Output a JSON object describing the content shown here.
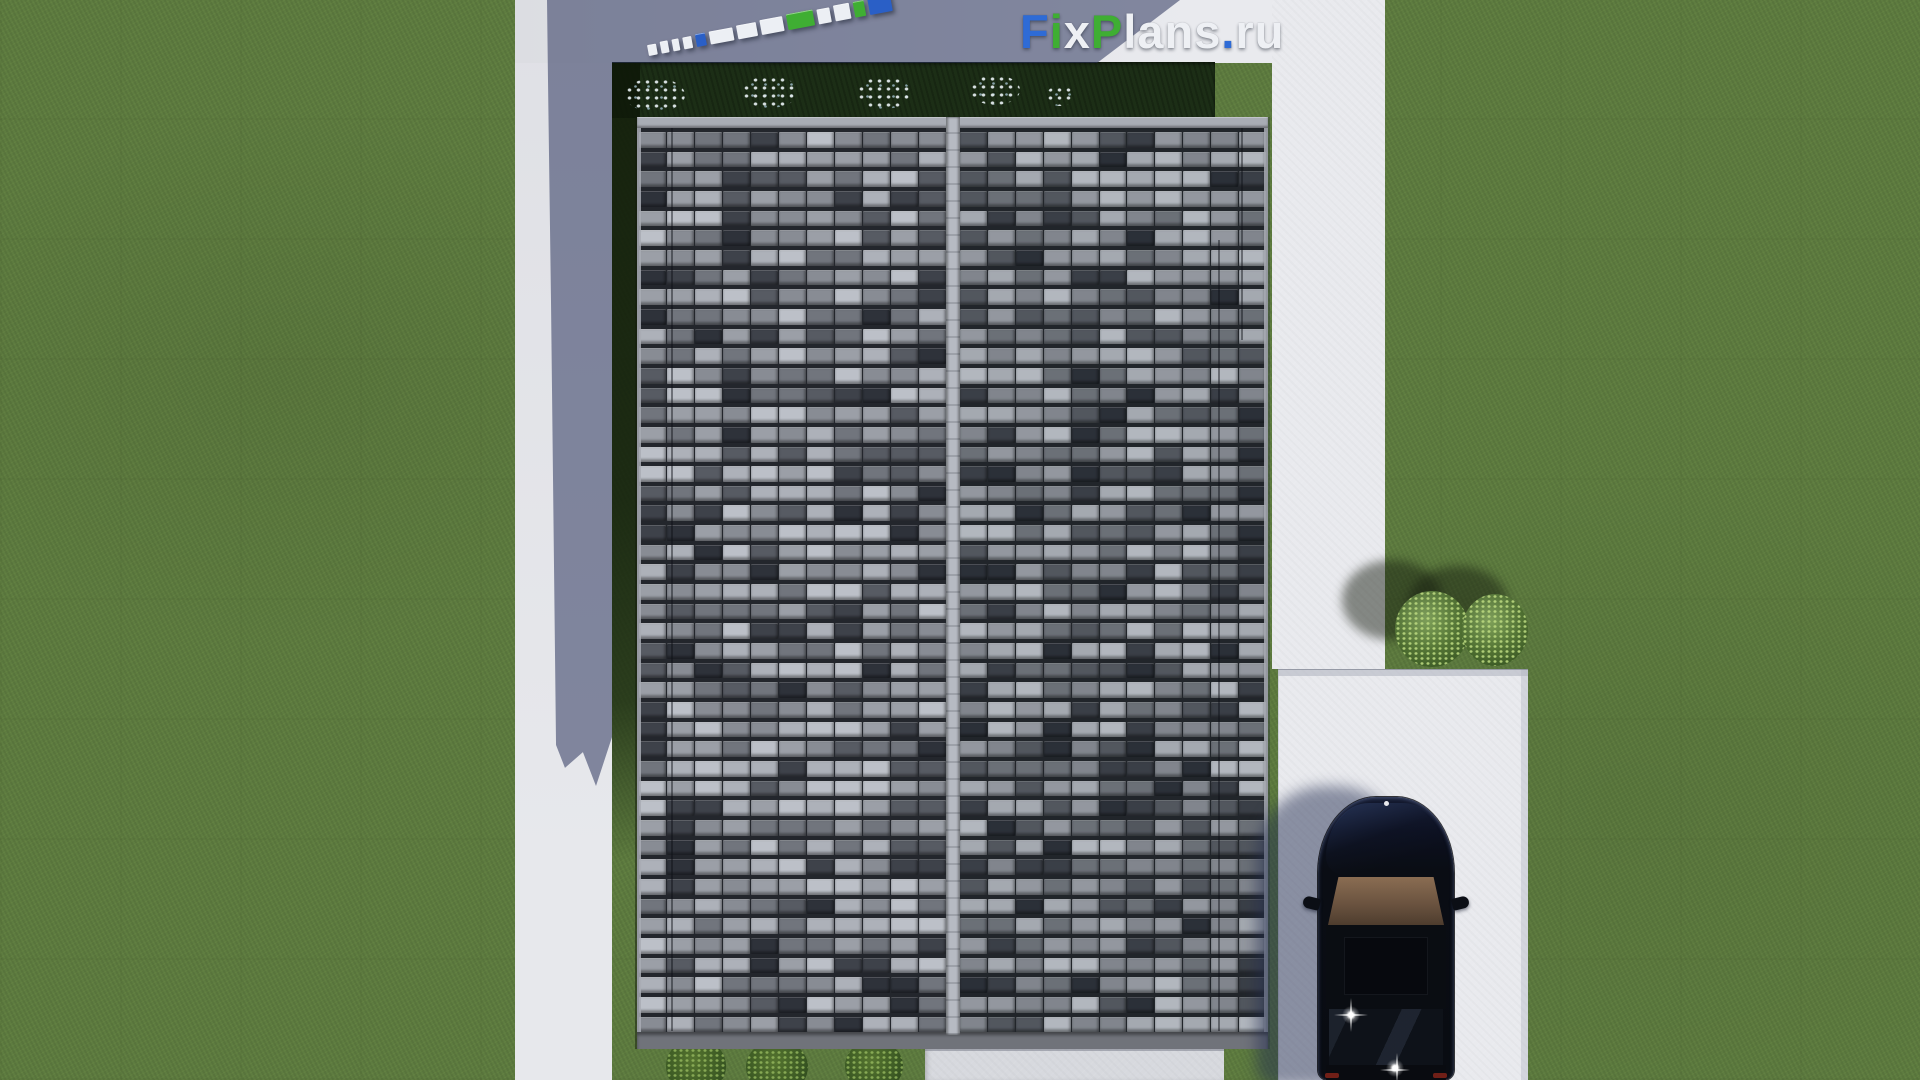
{
  "meta": {
    "width_px": 1920,
    "height_px": 1080,
    "description": "Aerial top-down 3D render of a gabled tiled house roof with lawn, concrete walkways, driveway, parked dark car, bushes and FixPlans.ru watermark"
  },
  "watermark": {
    "text": "FixPlans.ru",
    "parts": [
      {
        "t": "F",
        "color": "#2e6bd6"
      },
      {
        "t": "i",
        "color": "#3fae33"
      },
      {
        "t": "x",
        "color": "#eef0f4"
      },
      {
        "t": "P",
        "color": "#3fae33"
      },
      {
        "t": "lans",
        "color": "#eef0f4"
      },
      {
        "t": ".",
        "color": "#2e6bd6"
      },
      {
        "t": "ru",
        "color": "#eef0f4"
      }
    ]
  },
  "logo3d": {
    "angle_deg": -10.5,
    "segments": [
      {
        "w": 9,
        "h": 11,
        "color": "#eceff4"
      },
      {
        "w": 8,
        "h": 12,
        "color": "#eceff4"
      },
      {
        "w": 7,
        "h": 12,
        "color": "#eceff4"
      },
      {
        "w": 9,
        "h": 12,
        "color": "#eceff4"
      },
      {
        "w": 10,
        "h": 13,
        "color": "#2a5fc6"
      },
      {
        "w": 24,
        "h": 13,
        "color": "#eceff4"
      },
      {
        "w": 20,
        "h": 14,
        "color": "#eceff4"
      },
      {
        "w": 23,
        "h": 15,
        "color": "#eceff4"
      },
      {
        "w": 27,
        "h": 16,
        "color": "#3fae33"
      },
      {
        "w": 13,
        "h": 15,
        "color": "#eceff4"
      },
      {
        "w": 16,
        "h": 16,
        "color": "#eceff4"
      },
      {
        "w": 11,
        "h": 16,
        "color": "#3fae33"
      },
      {
        "w": 23,
        "h": 22,
        "color": "#2a5fc6"
      }
    ]
  },
  "colors": {
    "lawn": "#5e7c40",
    "concrete": "#dfe0e5",
    "concrete_bright": "#e9eaee",
    "patio": "#d7d9de",
    "shadow_tint": "rgba(44,52,92,0.55)",
    "hedge": "#1c2e16",
    "ridge": "#b2b6be",
    "fascia_top": "#a9adb5",
    "fascia_bottom": "#70737a",
    "roof_gap": "#23262c",
    "car_body": "#0a0d14",
    "car_glass": "#0e1219",
    "car_sunroof": "#07090e",
    "windshield_top": "#8a6d52",
    "windshield_bottom": "#4e3d2e",
    "logo_blue": "#2a5fc6",
    "logo_green": "#3fae33",
    "logo_white": "#eceff4"
  },
  "roof": {
    "rows": 46,
    "cols": 11,
    "seed": 11,
    "palette": [
      "#bcc0c8",
      "#adb1b9",
      "#9b9fa7",
      "#888c94",
      "#71757d",
      "#575b63",
      "#3e424a",
      "#2e323a"
    ],
    "weights": [
      12,
      14,
      16,
      16,
      14,
      12,
      9,
      7
    ],
    "seams": [
      {
        "x": 671,
        "y1": 128,
        "y2": 1031
      },
      {
        "x": 1218,
        "y1": 240,
        "y2": 1031
      },
      {
        "x": 1241,
        "y1": 128,
        "y2": 340
      }
    ]
  },
  "vegetation": {
    "flower_clusters": [
      {
        "x": 625,
        "y": 78,
        "w": 60,
        "h": 34
      },
      {
        "x": 742,
        "y": 76,
        "w": 56,
        "h": 32
      },
      {
        "x": 857,
        "y": 77,
        "w": 54,
        "h": 32
      },
      {
        "x": 970,
        "y": 75,
        "w": 50,
        "h": 30
      },
      {
        "x": 1046,
        "y": 86,
        "w": 28,
        "h": 20
      }
    ],
    "bottom_bushes": [
      {
        "x": 666,
        "y": 1038,
        "w": 60,
        "h": 56
      },
      {
        "x": 746,
        "y": 1040,
        "w": 62,
        "h": 54
      },
      {
        "x": 845,
        "y": 1040,
        "w": 58,
        "h": 52
      }
    ],
    "right_bushes": [
      {
        "x": 1395,
        "y": 591,
        "w": 74,
        "h": 76
      },
      {
        "x": 1462,
        "y": 594,
        "w": 66,
        "h": 72
      }
    ],
    "right_bush_shadows": [
      {
        "x": 1342,
        "y": 560,
        "w": 100,
        "h": 80
      },
      {
        "x": 1408,
        "y": 566,
        "w": 100,
        "h": 76
      }
    ]
  }
}
